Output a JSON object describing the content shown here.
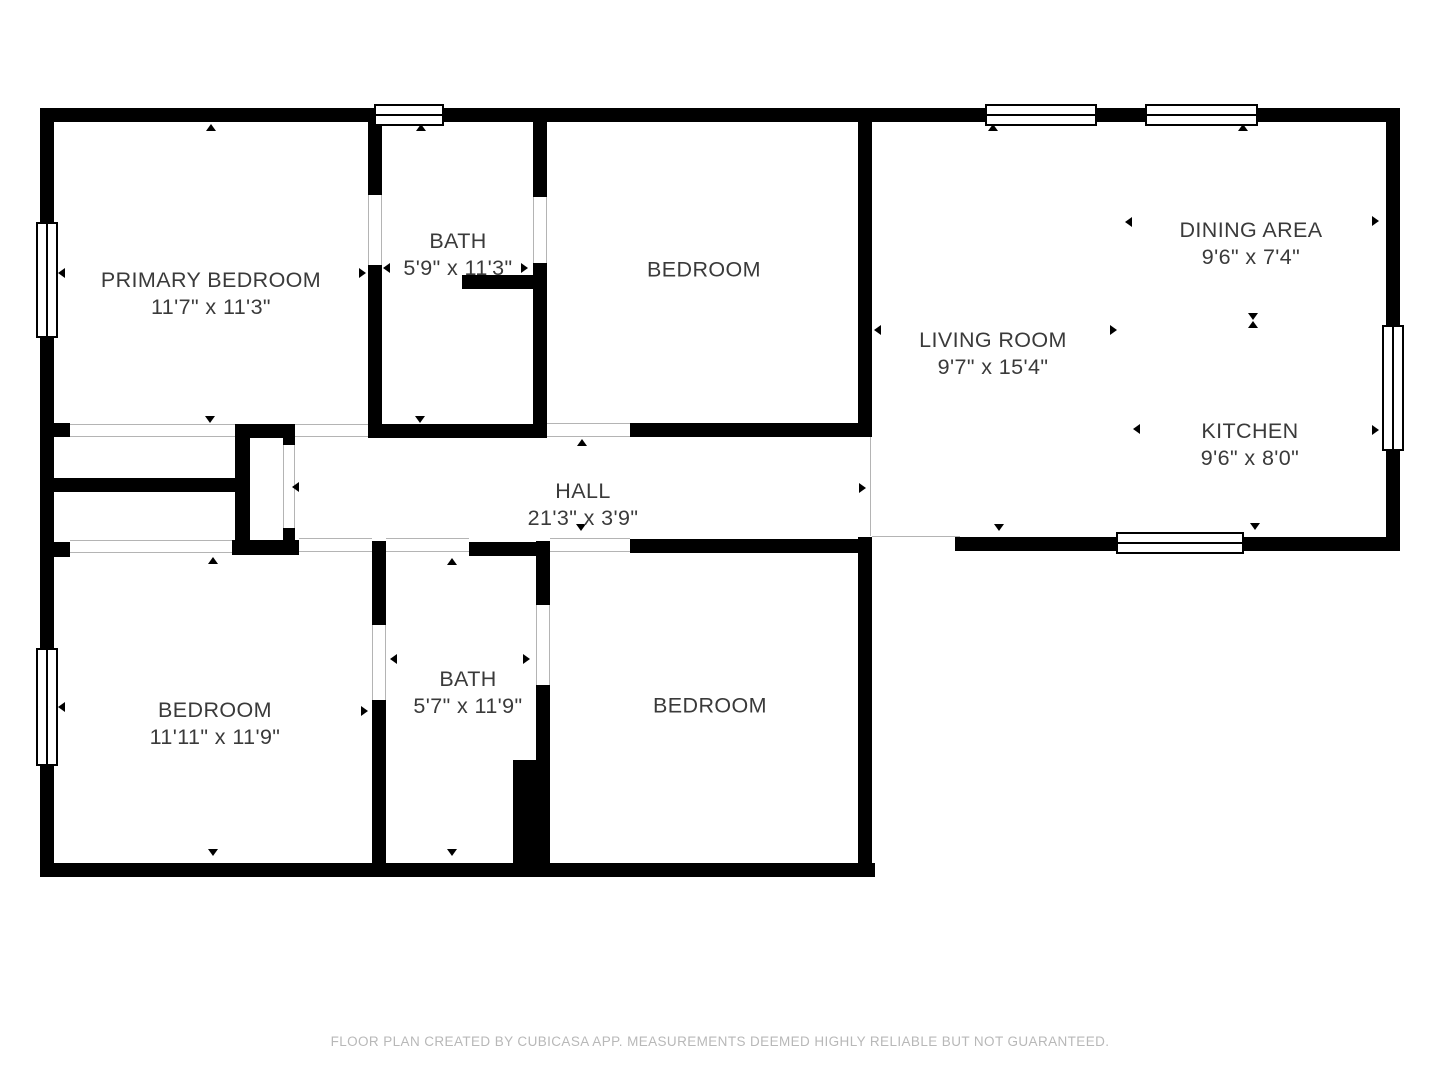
{
  "floor_plan": {
    "rooms": {
      "primary_bedroom": {
        "name": "PRIMARY BEDROOM",
        "dims": "11'7\" x 11'3\""
      },
      "bath_top": {
        "name": "BATH",
        "dims": "5'9\" x 11'3\""
      },
      "bedroom_top": {
        "name": "BEDROOM"
      },
      "living_room": {
        "name": "LIVING ROOM",
        "dims": "9'7\" x 15'4\""
      },
      "dining_area": {
        "name": "DINING AREA",
        "dims": "9'6\" x 7'4\""
      },
      "kitchen": {
        "name": "KITCHEN",
        "dims": "9'6\" x 8'0\""
      },
      "hall": {
        "name": "HALL",
        "dims": "21'3\" x 3'9\""
      },
      "bedroom_bottom_left": {
        "name": "BEDROOM",
        "dims": "11'11\" x 11'9\""
      },
      "bath_bottom": {
        "name": "BATH",
        "dims": "5'7\" x 11'9\""
      },
      "bedroom_bottom": {
        "name": "BEDROOM"
      }
    },
    "footer": "FLOOR PLAN CREATED BY CUBICASA APP. MEASUREMENTS DEEMED HIGHLY RELIABLE BUT NOT GUARANTEED.",
    "colors": {
      "wall": "#000000",
      "opening_line": "#b4b4b4",
      "label_text": "#3a3a3a",
      "footer_text": "#b8b8b8",
      "background": "#ffffff"
    }
  }
}
